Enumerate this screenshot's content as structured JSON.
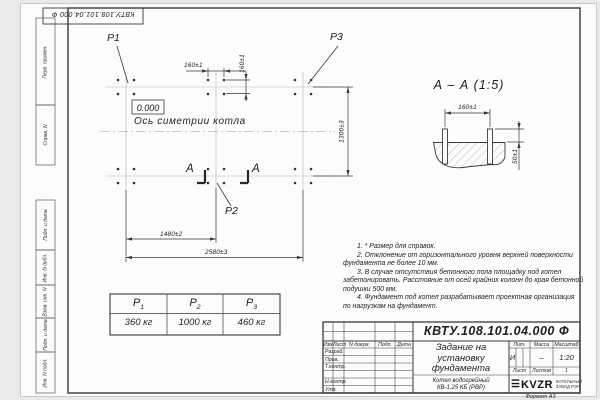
{
  "sheet": {
    "corner_stamp": "КВТУ.108.101.04.000 Ф",
    "format_label": "Формат А3",
    "side_strip": [
      "Перв. примен.",
      "Справ. N",
      "Подп. и дата",
      "Инв. N дубл.",
      "Взам. инв. N",
      "Подп. и дата",
      "Инв. N подл."
    ]
  },
  "plan": {
    "label_p1": "P1",
    "label_p2": "P2",
    "label_p3": "P3",
    "level_mark": "0.000",
    "axis_label": "Ось симетрии котла",
    "dim_bolt_h": "160±1",
    "dim_bolt_v": "160±1",
    "dim_rows": "1300±3",
    "dim_mid": "1480±2",
    "dim_total": "2580±3",
    "section_letter_left": "А",
    "section_letter_right": "А"
  },
  "section_view": {
    "title": "А – А (1:5)",
    "dim_spacing": "160±1",
    "dim_height": "50±1"
  },
  "load_table": {
    "col1_base": "P",
    "col1_sub": "1",
    "col2_base": "P",
    "col2_sub": "2",
    "col3_base": "P",
    "col3_sub": "3",
    "val1": "360 кг",
    "val2": "1000 кг",
    "val3": "460 кг"
  },
  "notes": {
    "lines": [
      "1. * Размер для справок.",
      "2. Отклонение от горизонтального уровня верхней поверхности",
      "фундамента не более 10 мм.",
      "3. В случае отсутствия бетонного пола площадку под котел",
      "забетонировать. Расстояние от осей крайних колонн до края бетонной",
      "подушки 500 мм.",
      "4. Фундамент под котел разрабатывает проектная организация",
      "по нагрузкам на фундамент."
    ]
  },
  "title_block": {
    "doc_number": "КВТУ.108.101.04.000  Ф",
    "title_line1": "Задание на",
    "title_line2": "установку",
    "title_line3": "фундамента",
    "product_line1": "Котел водогрейный",
    "product_line2": "КВ-1,25 КБ (РВР)",
    "header_izm": "Изм.",
    "header_list": "Лист",
    "header_ndoc": "N докум.",
    "header_podp": "Подп.",
    "header_data": "Дата",
    "rows": [
      "Разраб.",
      "Пров.",
      "Т.контр.",
      "Н.контр.",
      "Утв."
    ],
    "lit_header": "Лит.",
    "mass_header": "Масса",
    "scale_header": "Масштаб",
    "lit_value": "И",
    "mass_value": "–",
    "scale_value": "1:20",
    "sheet_label": "Лист",
    "sheets_label": "Листов",
    "sheets_value": "1",
    "logo_text": "KVZR",
    "logo_caption1": "КОТЕЛЬНЫЙ",
    "logo_caption2": "ЗАВОД РЭП"
  }
}
